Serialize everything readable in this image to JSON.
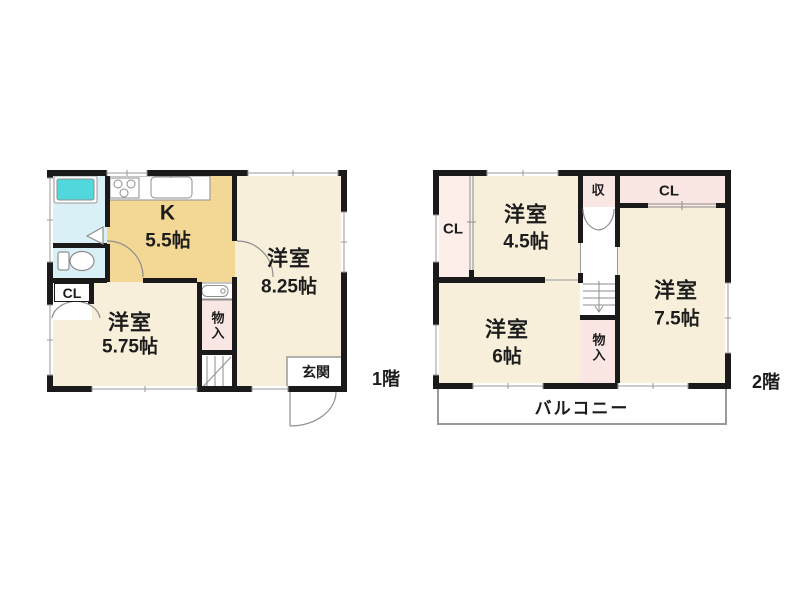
{
  "title": "間取り図",
  "colors": {
    "wall": "#1a1a1a",
    "room_cream": "#f7efd9",
    "kitchen_tan": "#f3d795",
    "storage_pink": "#fae7e3",
    "wet_cyan": "#d9f1f6",
    "bathtub_cyan": "#50d8dc",
    "line_grey": "#8e8e8e"
  },
  "floor1": {
    "name_label": "1階",
    "kitchen": {
      "line1": "K",
      "line2": "5.5帖"
    },
    "room825": {
      "line1": "洋室",
      "line2": "8.25帖"
    },
    "room575": {
      "line1": "洋室",
      "line2": "5.75帖"
    },
    "closet": "CL",
    "storage": "物入",
    "entrance": "玄関"
  },
  "floor2": {
    "name_label": "2階",
    "room45": {
      "line1": "洋室",
      "line2": "4.5帖"
    },
    "room75": {
      "line1": "洋室",
      "line2": "7.5帖"
    },
    "room6": {
      "line1": "洋室",
      "line2": "6帖"
    },
    "closet_left": "CL",
    "closet_right": "CL",
    "storage_upper": "収",
    "storage_lower": "物入",
    "balcony": "バルコニー"
  }
}
